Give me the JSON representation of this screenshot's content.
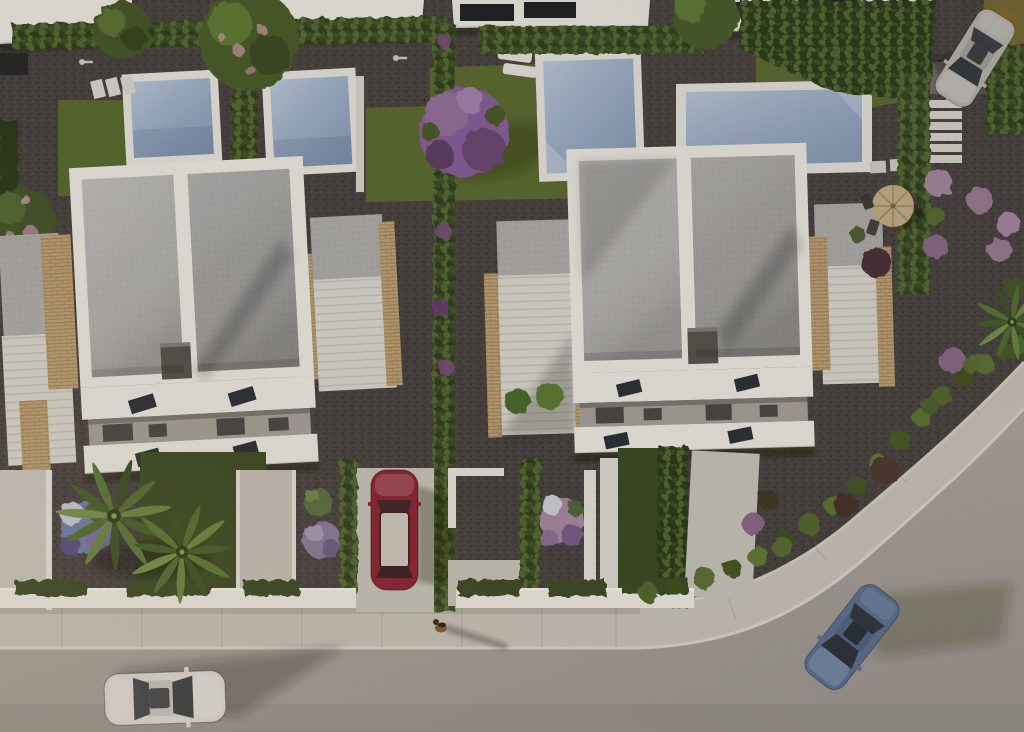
{
  "scene": {
    "type": "aerial-3d-architectural-render",
    "subject": "top-down evening view of two modern duplex villas with private pools, hedged gardens, palm trees and a curved street with cars"
  },
  "palette": {
    "gravel": "#4b4542",
    "road": "#b0a8a1",
    "sidewalk": "#cbc4ba",
    "curb": "#dcd6cb",
    "lawn": "#5c6c31",
    "lawnShade": "#3e4c23",
    "hedge": "#3c4c25",
    "hedgeDark": "#2d3b1c",
    "water": "#a5b9d1",
    "deck": "#e9e6de",
    "roof": "#b5b3af",
    "roofShade": "#a3a19d",
    "wall": "#efece3",
    "wallShade": "#d8d4c9",
    "stone": "#bfa276",
    "terrace": "#dcd9d0",
    "patio": "#c9c4bb",
    "chimney": "#57534d",
    "glass": "#2d3137",
    "carRed": "#8e2433",
    "carBlue": "#5d7293",
    "carWhite": "#dfdcd7",
    "carSilver": "#bdb9b0",
    "treePurple": "#8a619b",
    "treeGreen": "#4c5d2c",
    "flowerPink": "#a98aa2",
    "flowerBlue": "#6f7fa8",
    "parasol": "#c7b089",
    "dogBrown": "#8a5a33"
  },
  "inventory": {
    "villas": 2,
    "pools": 4,
    "neighborBuildings": 4,
    "vehicles": [
      {
        "name": "white-hatchback",
        "where": "road-bottom-left"
      },
      {
        "name": "blue-sedan",
        "where": "curved-road-bottom-right"
      },
      {
        "name": "red-coupe",
        "where": "center-driveway"
      },
      {
        "name": "silver-suv",
        "where": "top-right-parking"
      }
    ],
    "animal": {
      "name": "small-dog",
      "where": "sidewalk-center"
    },
    "furniture": [
      "dark-sun-loungers",
      "white-sun-loungers",
      "round-parasol-table",
      "garden-chairs"
    ],
    "vegetation": [
      "cypress-hedge-rows",
      "palm-trees",
      "purple-flowering-tree",
      "pink-flower-bushes",
      "blue-flower-bed",
      "lawns",
      "purple-ball-bush"
    ]
  }
}
